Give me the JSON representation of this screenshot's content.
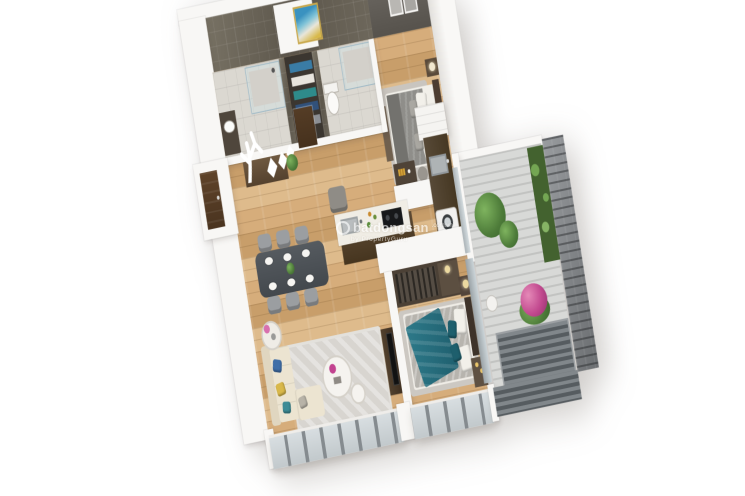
{
  "canvas": {
    "width": 745,
    "height": 496,
    "background": "#ffffff",
    "type": "3D isometric floor-plan render",
    "subject": "two-bedroom apartment with two bathrooms, open kitchen-dining-living area and planted balcony"
  },
  "watermark": {
    "brand": "batdongsan",
    "domain": ".com.vn",
    "byline": "by PropertyGuru",
    "text_color": "#ffffff"
  },
  "palette": {
    "wood_floor": "#cda26f",
    "white_wall": "#f8f7f5",
    "dark_tile_wall": "#6b6559",
    "light_tile_floor": "#dbd8d1",
    "kitchen_cabinet": "#54432f",
    "sofa_cream": "#ece4d1",
    "accent_teal": "#2a7484",
    "accent_blue": "#3f6ea8",
    "accent_mustard": "#d9b84a",
    "accent_pink": "#c2498f",
    "plant_green": "#4e7c3a",
    "balcony_brick": "#7d8083",
    "window_frame": "#858b8f",
    "rug_gray": "#d7d4cf",
    "door_brown": "#5a4028",
    "gray_bedding": "#8f8e8a"
  },
  "rooms": [
    {
      "id": "bathroom-1",
      "features": [
        "walk-in shower",
        "vanity sink",
        "dark tiled walls"
      ]
    },
    {
      "id": "shelf-niche",
      "features": [
        "storage shelves with books",
        "framed artwork on wall"
      ]
    },
    {
      "id": "bathroom-2",
      "features": [
        "walk-in shower",
        "toilet"
      ]
    },
    {
      "id": "bedroom-1",
      "features": [
        "double bed",
        "dark headboard",
        "nightstand with lamp",
        "foot bench",
        "two wall frames",
        "breakfast table"
      ]
    },
    {
      "id": "entry-hall",
      "features": [
        "front door",
        "interior door",
        "console with white tree decor",
        "potted plant",
        "accent chair"
      ]
    },
    {
      "id": "kitchen",
      "features": [
        "island with sink and cooktop",
        "wall counter with sink",
        "washing machine",
        "tall white cabinets"
      ]
    },
    {
      "id": "dining-area",
      "features": [
        "six-seat dining table",
        "place settings",
        "green centerpiece"
      ]
    },
    {
      "id": "living-room",
      "features": [
        "cream L-shaped sofa",
        "colorful cushions",
        "round coffee tables",
        "area rug",
        "TV cabinet",
        "side table with flowers"
      ]
    },
    {
      "id": "master-bedroom",
      "features": [
        "double bed with teal throw",
        "open wardrobe with clothes",
        "dresser",
        "nightstand with lamp",
        "desk"
      ]
    },
    {
      "id": "balcony",
      "features": [
        "large potted plant",
        "vertical garden wall",
        "pink flower bush",
        "louvered deck",
        "grey brick feature wall",
        "stool"
      ]
    }
  ]
}
